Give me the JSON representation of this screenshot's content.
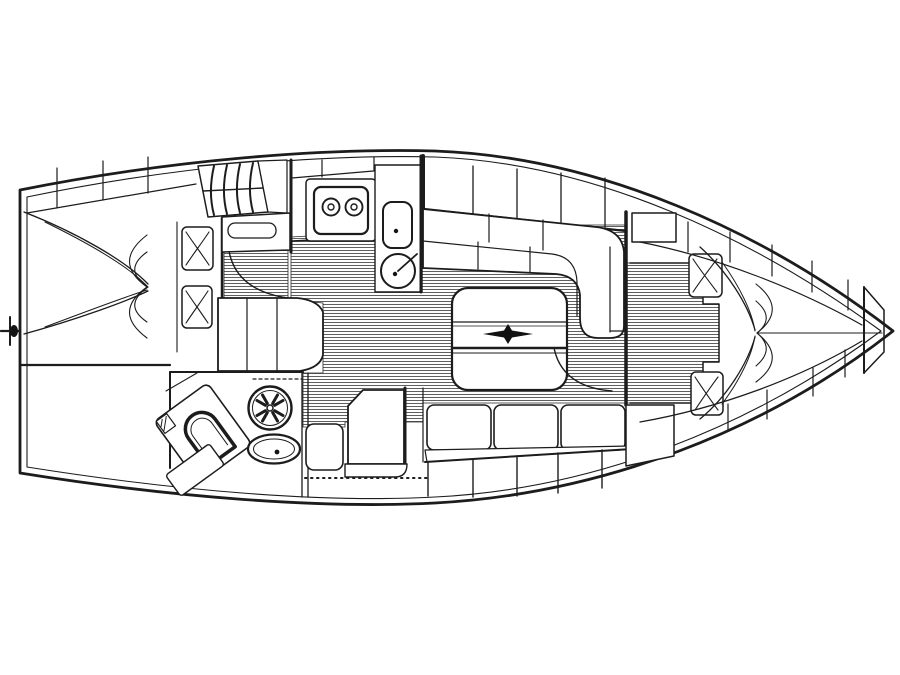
{
  "meta": {
    "description": "Top-down interior layout plan of a sailing yacht, black line drawing on white; bow at right, transom stern at left",
    "diagram_type": "boat-floor-plan"
  },
  "colors": {
    "line": "#1c1c1c",
    "background": "#ffffff",
    "sole_hatch": "#5f5f5f",
    "furniture_fill": "#ffffff",
    "table_star": "#111111"
  },
  "components": {
    "aft_cabin": "aft double berth with quilt and two pillows",
    "companionway": "companionway steps and engine cover",
    "galley": "two-burner stove, rectangular sink, round sink with faucet",
    "wardrobe": "curved-front cabinet",
    "head": "toilet, washbasin, shower fan grille, shelf",
    "saloon": "U-settee with folding table and mast star, straight settee",
    "nav_station": "chart table with seat",
    "fore_cabin": "V-berth with quilt, two pillows, bow anchor well",
    "hull": "double hull outline with side lockers and stern fitting"
  }
}
